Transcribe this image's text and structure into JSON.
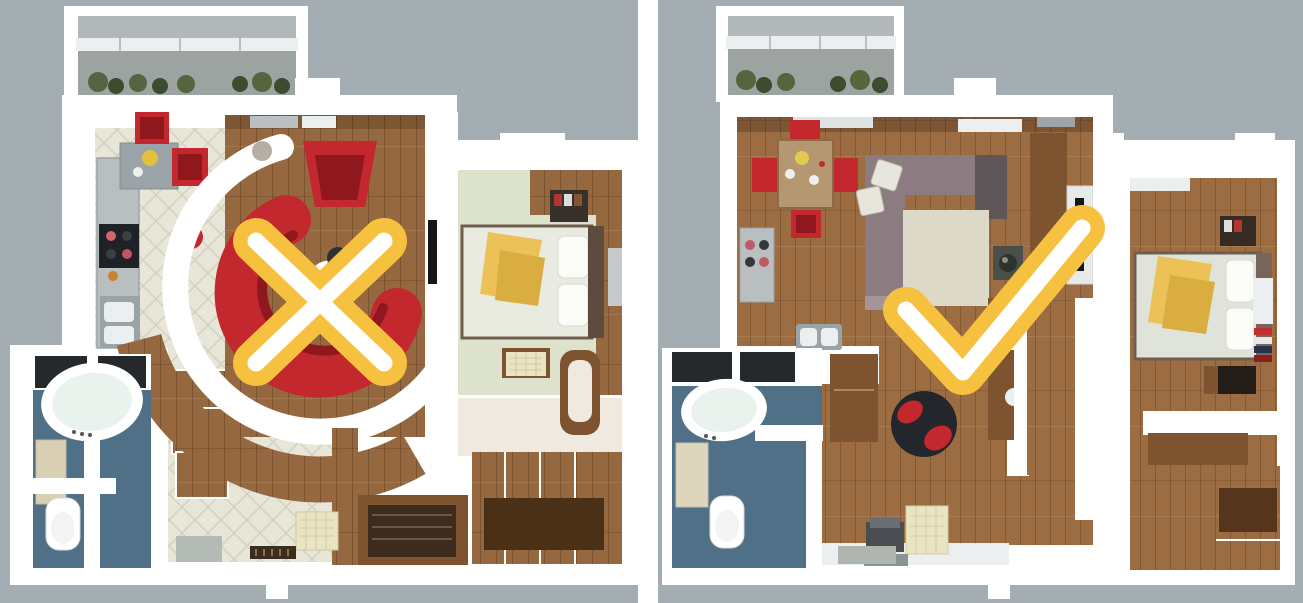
{
  "scene": {
    "type": "floorplan-comparison",
    "panels": [
      {
        "position": "left",
        "marker": "cross-icon",
        "meaning": "rejected-layout",
        "rooms": [
          "balcony",
          "kitchen",
          "living-room",
          "bedroom",
          "bathroom",
          "hallway",
          "dressing-room"
        ]
      },
      {
        "position": "right",
        "marker": "check-icon",
        "meaning": "approved-layout",
        "rooms": [
          "balcony",
          "open-living-dining",
          "kitchen",
          "bedroom",
          "bathroom",
          "workspace"
        ]
      }
    ]
  },
  "colors": {
    "bg": "#a3adb2",
    "divider": "#ffffff",
    "wall": "#ffffff",
    "wall_shade": "#e2e6e8",
    "white_soft": "#eceff0",
    "wood": "#96683f",
    "wood_right": "#9c6c42",
    "wood_dark": "#7d5330",
    "wood_deep": "#4a3017",
    "tile": "#e8e6d8",
    "tile_line": "#d2d0bf",
    "pale_floor": "#dde2cc",
    "light_floor": "#efe9df",
    "bath_blue": "#4f7086",
    "dark_shadow": "#26292c",
    "red": "#c2282d",
    "red_dark": "#8e181d",
    "gray_sofa": "#8d7b82",
    "gray_sofa_dark": "#5f5659",
    "rug": "#dcd9c8",
    "cream": "#e9e4c2",
    "yellow": "#ecc258",
    "yellow_dark": "#d9ad3f",
    "counter": "#b9bec0",
    "steel": "#9aa3a7",
    "appliance_dark": "#1e2226",
    "balcony_roof": "#b2b8ba",
    "balcony_floor": "#9da3a1",
    "plant": "#55663f",
    "plant_dark": "#3c4c2e",
    "sill": "#b9bfc2",
    "headboard": "#5d4b3d",
    "mattress": "#e9ebe1",
    "table_dark": "#2c3137",
    "mark_yellow": "#f6c13f",
    "mark_white": "#ffffff"
  }
}
